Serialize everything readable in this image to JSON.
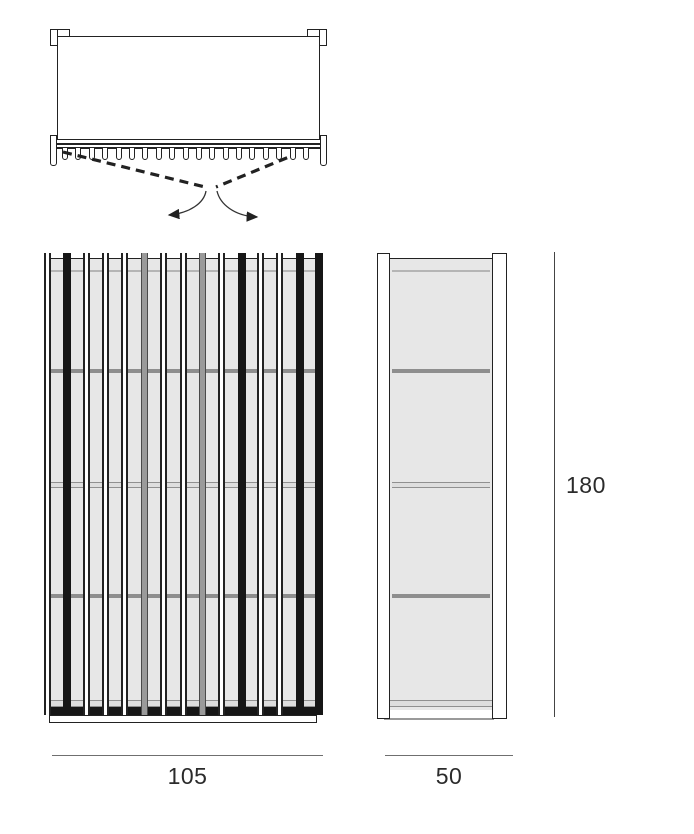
{
  "title": "wardrobe-technical-drawing",
  "colors": {
    "line": "#222222",
    "panel_fill": "#e7e7e7",
    "panel_inner_line": "#b5b5b5",
    "shelf_solid": "#8e8e8e",
    "shelf_edge": "#909090",
    "slat_dark": "#161616",
    "slat_gray": "#9a9a9a",
    "dim_line": "#6f6f6f",
    "dim_text": "#2b2b2b"
  },
  "top_view": {
    "description": "plan view with double doors swinging outward",
    "peg_count": 19
  },
  "front_view": {
    "description": "front elevation with vertical slats",
    "slat_pattern": [
      "outline",
      "solid",
      "outline",
      "outline",
      "outline",
      "gray",
      "outline",
      "outline",
      "gray",
      "outline",
      "solid",
      "outline",
      "outline",
      "solid",
      "solid"
    ],
    "shelves": [
      {
        "pos": 0.25,
        "style": "solid"
      },
      {
        "pos": 0.5,
        "style": "double"
      },
      {
        "pos": 0.75,
        "style": "solid"
      }
    ]
  },
  "side_view": {
    "description": "side elevation",
    "shelves": [
      {
        "pos": 0.25,
        "style": "solid"
      },
      {
        "pos": 0.5,
        "style": "double"
      },
      {
        "pos": 0.75,
        "style": "solid"
      }
    ]
  },
  "dimensions": {
    "width": "105",
    "depth": "50",
    "height": "180"
  }
}
